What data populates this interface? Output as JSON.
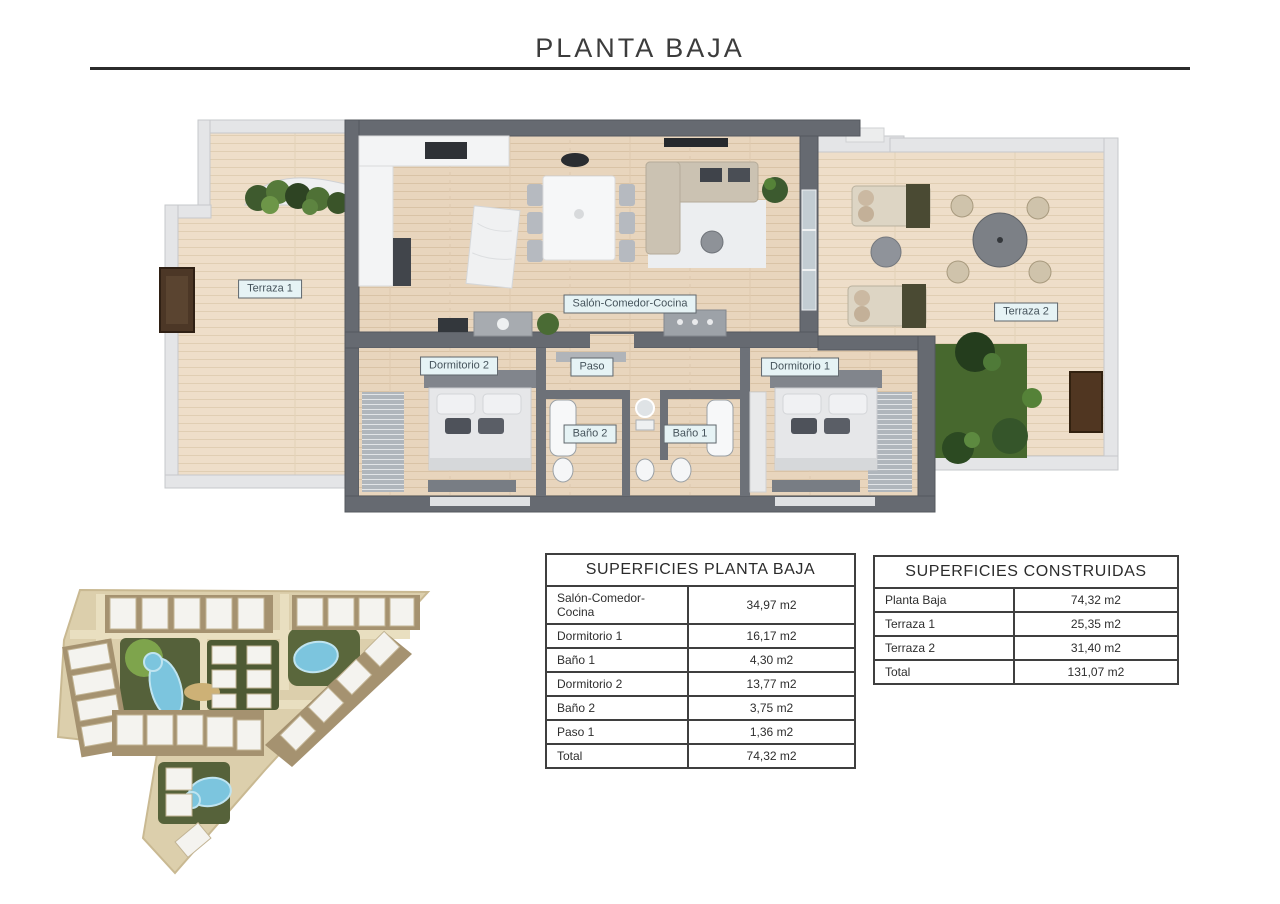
{
  "title": "PLANTA BAJA",
  "floor_plan": {
    "rooms": {
      "terraza1": "Terraza 1",
      "salon": "Salón-Comedor-Cocina",
      "paso": "Paso",
      "dormitorio2": "Dormitorio 2",
      "dormitorio1": "Dormitorio 1",
      "bano2": "Baño 2",
      "bano1": "Baño 1",
      "terraza2": "Terraza 2"
    }
  },
  "tables": {
    "planta_baja": {
      "title": "SUPERFICIES PLANTA BAJA",
      "rows": [
        [
          "Salón-Comedor-Cocina",
          "34,97 m2"
        ],
        [
          "Dormitorio 1",
          "16,17 m2"
        ],
        [
          "Baño 1",
          "4,30 m2"
        ],
        [
          "Dormitorio 2",
          "13,77 m2"
        ],
        [
          "Baño 2",
          "3,75 m2"
        ],
        [
          "Paso 1",
          "1,36 m2"
        ],
        [
          "Total",
          "74,32 m2"
        ]
      ]
    },
    "construidas": {
      "title": "SUPERFICIES CONSTRUIDAS",
      "rows": [
        [
          "Planta Baja",
          "74,32 m2"
        ],
        [
          "Terraza 1",
          "25,35 m2"
        ],
        [
          "Terraza 2",
          "31,40 m2"
        ],
        [
          "Total",
          "131,07 m2"
        ]
      ]
    }
  },
  "colors": {
    "label_bg": "#e6f3f5",
    "label_border": "#5f666c",
    "label_text": "#45535b",
    "table_border": "#3f3f3f",
    "wall_dark": "#666a71",
    "wall_light": "#e4e5e7",
    "floor_wood": "#e8d5bd",
    "pool_blue": "#7cc5de",
    "grass_green": "#47682e"
  }
}
